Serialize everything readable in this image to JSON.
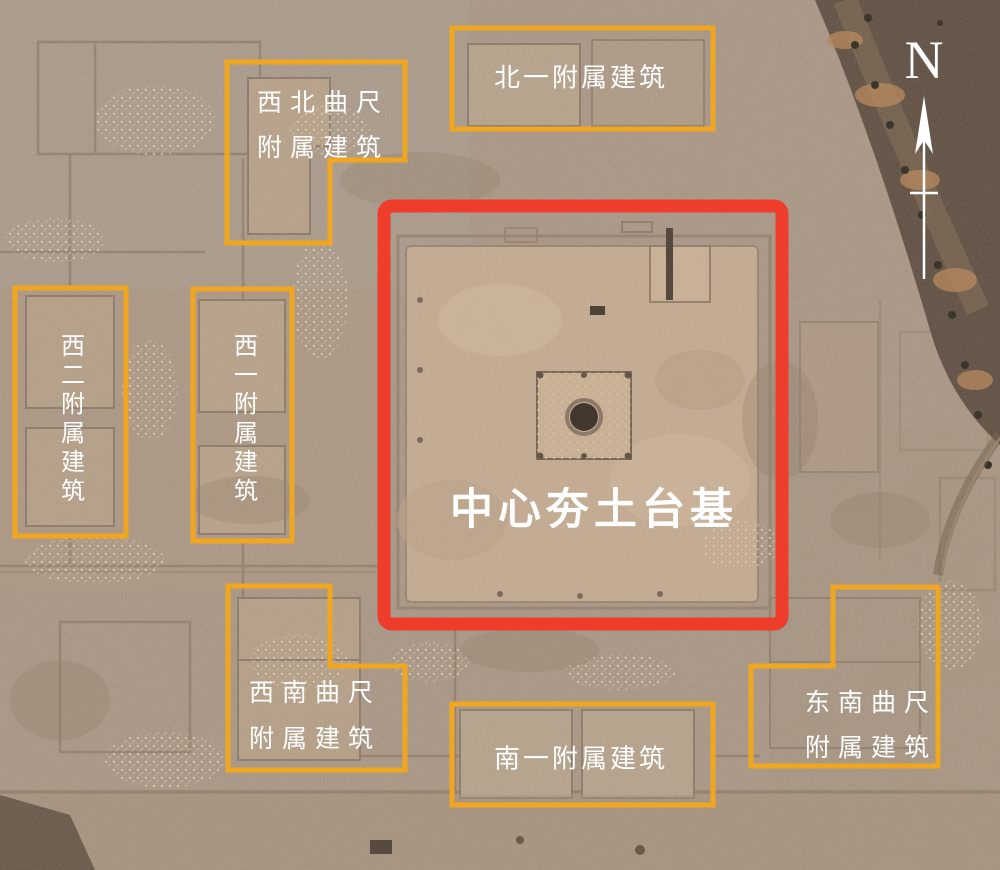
{
  "annotations": {
    "north": {
      "label": "北一附属建筑"
    },
    "northwest": {
      "line1": "西北曲尺",
      "line2": "附属建筑"
    },
    "west2": {
      "label": "西二附属建筑"
    },
    "west1": {
      "label": "西一附属建筑"
    },
    "center": {
      "label": "中心夯土台基"
    },
    "southwest": {
      "line1": "西南曲尺",
      "line2": "附属建筑"
    },
    "south": {
      "label": "南一附属建筑"
    },
    "southeast": {
      "line1": "东南曲尺",
      "line2": "附属建筑"
    },
    "compass": {
      "label": "N"
    }
  },
  "colors": {
    "box_yellow": "#F0A71F",
    "box_red": "#EE3D2B",
    "label_white": "#FFFFFF"
  }
}
